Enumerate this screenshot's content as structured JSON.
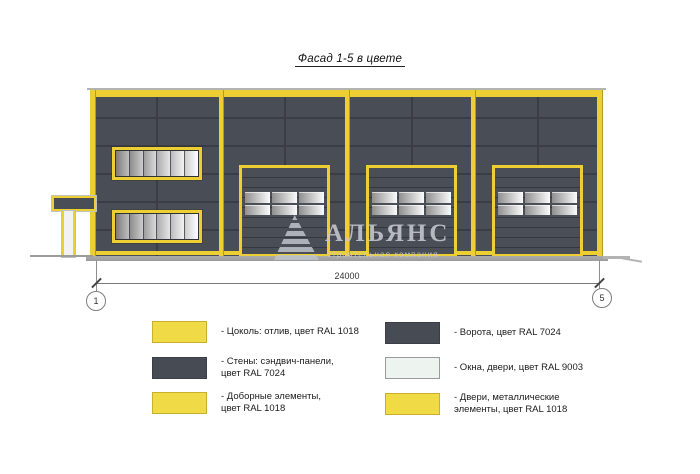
{
  "title": "Фасад 1-5 в цвете",
  "watermark": {
    "name": "АЛЬЯНС",
    "tagline": "строительная компания"
  },
  "dimension": {
    "value": "24000",
    "axis_start": "1",
    "axis_end": "5"
  },
  "facade": {
    "colors": {
      "wall_ral_7024": "#494D55",
      "panel_seam": "#3A3D44",
      "trim_ral_1018": "#EDCE33",
      "glazing_ral_9003": "#EFF4EF",
      "ground": "#A8A8A8"
    },
    "bays": 4,
    "overhead_doors": 3,
    "window_bands": 2,
    "panes_per_band": 6
  },
  "legend": {
    "items": [
      {
        "label": "- Цоколь: отлив, цвет RAL 1018",
        "color": "#F0DA45"
      },
      {
        "label": "- Стены: сэндвич-панели,\nцвет RAL 7024",
        "color": "#474B54"
      },
      {
        "label": "- Доборные элементы,\nцвет RAL 1018",
        "color": "#F0DA45"
      },
      {
        "label": "- Ворота, цвет RAL 7024",
        "color": "#474B54"
      },
      {
        "label": "- Окна, двери, цвет RAL 9003",
        "color": "#EDF3EE"
      },
      {
        "label": "- Двери, металлические\nэлементы, цвет RAL 1018",
        "color": "#F0DA45"
      }
    ]
  }
}
